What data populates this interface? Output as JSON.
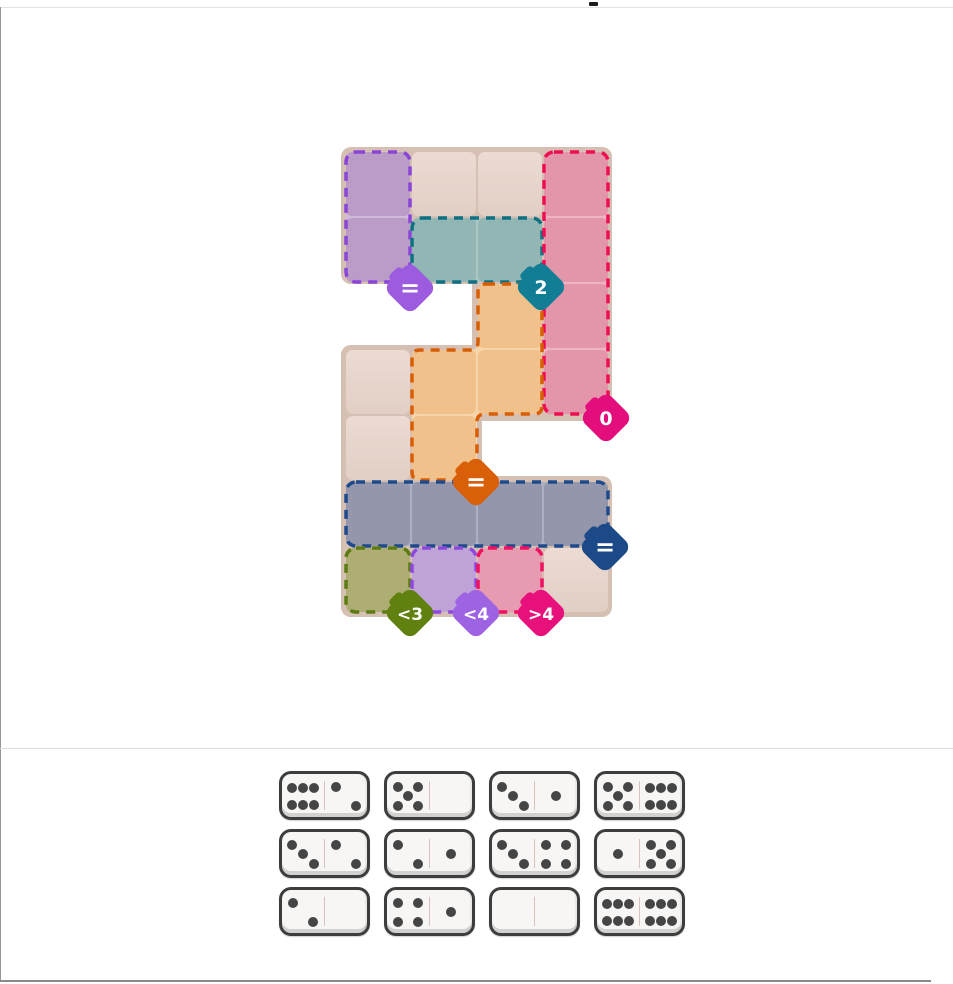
{
  "game": {
    "name": "domino-constraint-puzzle"
  },
  "board": {
    "bg_color": "#d6c0b3",
    "cell_top_color": "#ecdbd2",
    "cell_bottom_color": "#e1cfc6",
    "grid": {
      "cols": 4,
      "rows": 7,
      "cell": 64,
      "pitch": 66,
      "origin_x": 346,
      "origin_y": 152
    },
    "bg_rects": [
      [
        341,
        147,
        271,
        137
      ],
      [
        472,
        147,
        140,
        269
      ],
      [
        341,
        345,
        271,
        76
      ],
      [
        341,
        345,
        141,
        272
      ],
      [
        341,
        476,
        271,
        141
      ]
    ],
    "cells": [
      [
        0,
        0
      ],
      [
        1,
        0
      ],
      [
        2,
        0
      ],
      [
        3,
        0
      ],
      [
        0,
        1
      ],
      [
        1,
        1
      ],
      [
        2,
        1
      ],
      [
        3,
        1
      ],
      [
        2,
        2
      ],
      [
        3,
        2
      ],
      [
        0,
        3
      ],
      [
        1,
        3
      ],
      [
        2,
        3
      ],
      [
        3,
        3
      ],
      [
        0,
        4
      ],
      [
        1,
        4
      ],
      [
        0,
        5
      ],
      [
        1,
        5
      ],
      [
        2,
        5
      ],
      [
        3,
        5
      ],
      [
        0,
        6
      ],
      [
        1,
        6
      ],
      [
        2,
        6
      ],
      [
        3,
        6
      ]
    ],
    "regions": [
      {
        "id": "purple-tall",
        "cells": [
          [
            0,
            0
          ],
          [
            0,
            1
          ]
        ],
        "fill": "#ba9cc7",
        "light": "#cfb9db",
        "border": "#8a44d8",
        "badge": {
          "label": "=",
          "x": 410,
          "y": 288,
          "color": "#9d5ce0"
        }
      },
      {
        "id": "teal",
        "cells": [
          [
            1,
            1
          ],
          [
            2,
            1
          ]
        ],
        "fill": "#92b6b3",
        "light": "#aac7c4",
        "border": "#0e7183",
        "badge": {
          "label": "2",
          "x": 541,
          "y": 287,
          "color": "#117e96"
        }
      },
      {
        "id": "pink-tall",
        "cells": [
          [
            3,
            0
          ],
          [
            3,
            1
          ],
          [
            3,
            2
          ],
          [
            3,
            3
          ]
        ],
        "fill": "#e396a9",
        "light": "#efb4c2",
        "border": "#ee0e51",
        "badge": {
          "label": "0",
          "x": 606,
          "y": 418,
          "color": "#e30d7c"
        }
      },
      {
        "id": "orange",
        "cells": [
          [
            2,
            2
          ],
          [
            2,
            3
          ],
          [
            1,
            3
          ],
          [
            1,
            4
          ]
        ],
        "fill": "#f1c18b",
        "light": "#f7d5ab",
        "border": "#d85d07",
        "outline_path": "M486,284 H534 Q542,284 542,292 V406 Q542,414 534,414 H485 Q477,414 477,422 V472 Q477,480 469,480 H420 Q412,480 412,472 V358 Q412,350 420,350 H470 Q478,350 478,342 V292 Q478,284 486,284 Z",
        "badge": {
          "label": "=",
          "x": 476,
          "y": 482,
          "color": "#d95f09"
        }
      },
      {
        "id": "navy",
        "cells": [
          [
            0,
            5
          ],
          [
            1,
            5
          ],
          [
            2,
            5
          ],
          [
            3,
            5
          ]
        ],
        "fill": "#9496ab",
        "light": "#aeafc0",
        "border": "#1d4a8c",
        "badge": {
          "label": "=",
          "x": 605,
          "y": 547,
          "color": "#1c4a88"
        }
      },
      {
        "id": "olive",
        "cells": [
          [
            0,
            6
          ]
        ],
        "fill": "#aeae74",
        "light": "#c3c390",
        "border": "#5c7c12",
        "badge": {
          "label": "<3",
          "x": 410,
          "y": 613,
          "color": "#60800f"
        }
      },
      {
        "id": "purple-small",
        "cells": [
          [
            1,
            6
          ]
        ],
        "fill": "#c0a3d6",
        "light": "#d5bee5",
        "border": "#8f48de",
        "badge": {
          "label": "<4",
          "x": 476,
          "y": 613,
          "color": "#9d63e2"
        }
      },
      {
        "id": "pink-small",
        "cells": [
          [
            2,
            6
          ]
        ],
        "fill": "#e79bb0",
        "light": "#f1b5c6",
        "border": "#f01161",
        "badge": {
          "label": ">4",
          "x": 541,
          "y": 613,
          "color": "#e8117c"
        }
      }
    ]
  },
  "tray": {
    "dominoes": [
      [
        6,
        2
      ],
      [
        5,
        0
      ],
      [
        3,
        1
      ],
      [
        5,
        6
      ],
      [
        3,
        2
      ],
      [
        2,
        1
      ],
      [
        3,
        4
      ],
      [
        1,
        5
      ],
      [
        2,
        0
      ],
      [
        4,
        1
      ],
      [
        0,
        0
      ],
      [
        6,
        6
      ]
    ],
    "rows": 3,
    "cols": 4
  }
}
